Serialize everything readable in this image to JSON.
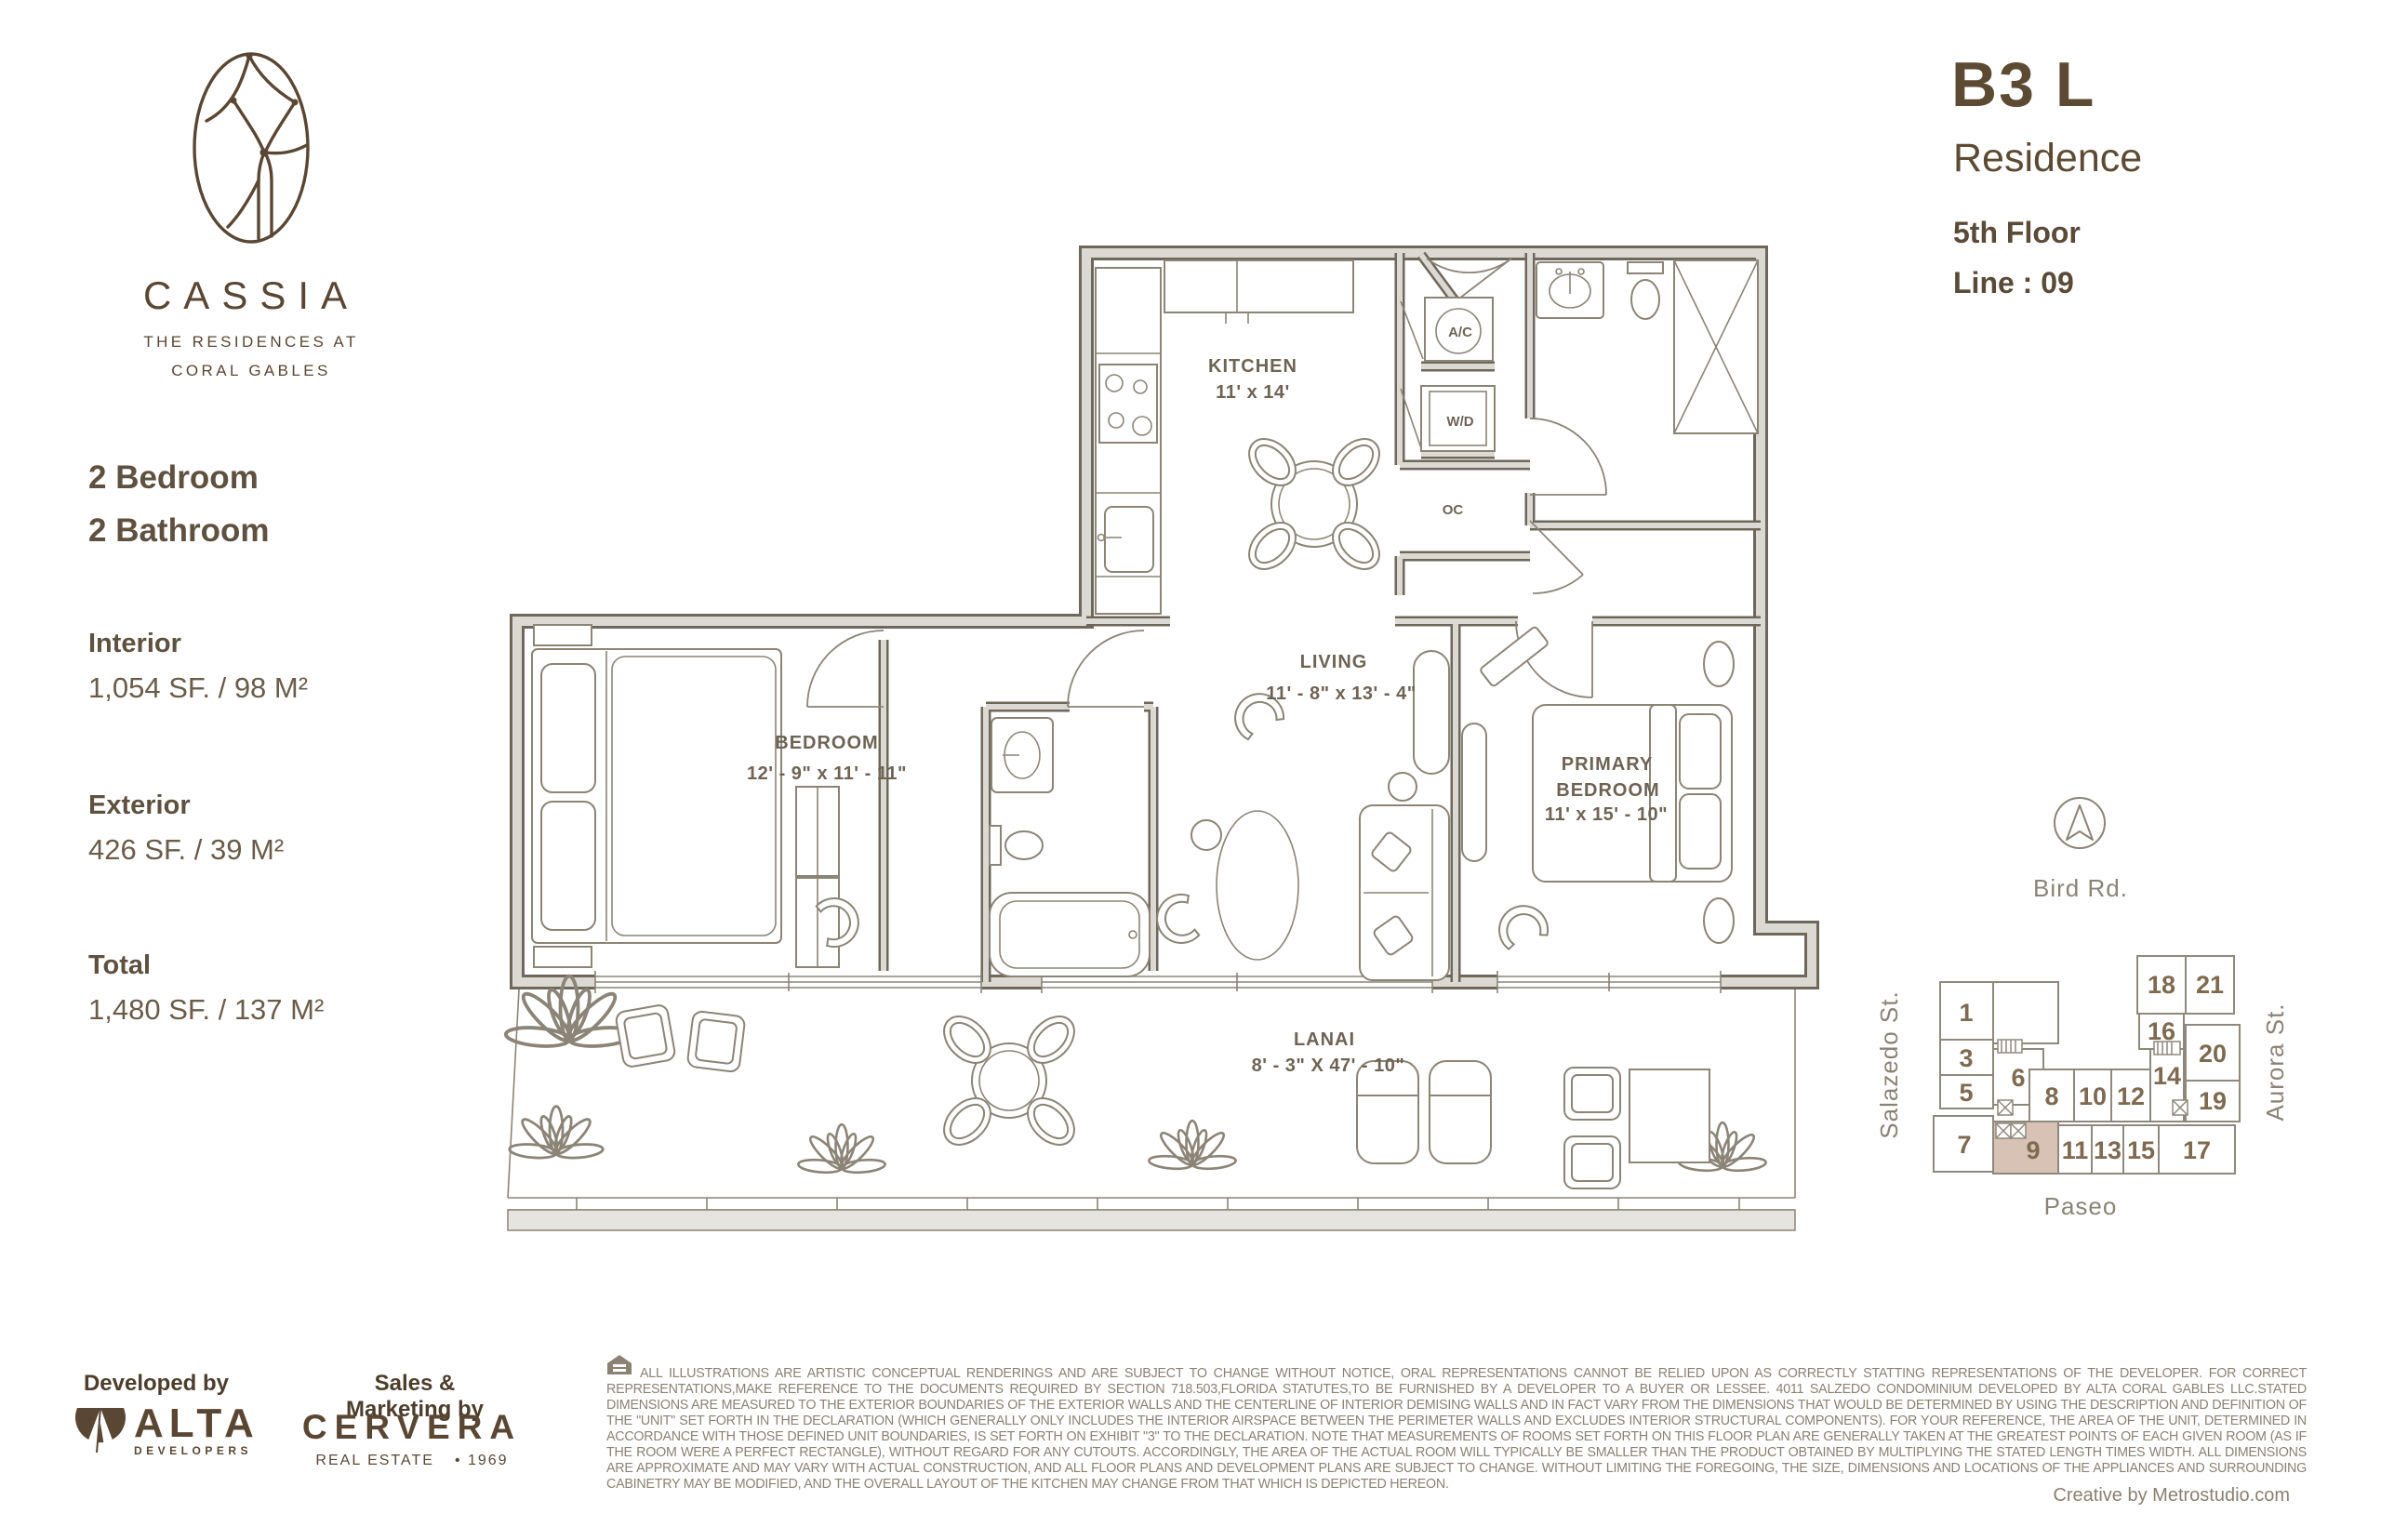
{
  "brand": {
    "name": "CASSIA",
    "tagline1": "THE RESIDENCES AT",
    "tagline2": "CORAL GABLES"
  },
  "unit": {
    "model": "B3 L",
    "label": "Residence",
    "floor": "5th Floor",
    "line": "Line : 09"
  },
  "summary": {
    "bedrooms": "2 Bedroom",
    "bathrooms": "2 Bathroom",
    "interior_label": "Interior",
    "interior": "1,054 SF. / 98 M²",
    "exterior_label": "Exterior",
    "exterior": "426 SF. / 39 M²",
    "total_label": "Total",
    "total": "1,480 SF. / 137 M²"
  },
  "plan": {
    "kitchen": {
      "name": "KITCHEN",
      "dims": "11' x 14'"
    },
    "living": {
      "name": "LIVING",
      "dims": "11' - 8\" x 13' - 4\""
    },
    "bedroom": {
      "name": "BEDROOM",
      "dims": "12' - 9\" x 11' - 11\""
    },
    "primary": {
      "line1": "PRIMARY",
      "line2": "BEDROOM",
      "dims": "11' x 15' - 10\""
    },
    "lanai": {
      "name": "LANAI",
      "dims": "8' - 3\" X 47' - 10\""
    },
    "closets": {
      "ac": "A/C",
      "wd": "W/D",
      "oc": "OC"
    }
  },
  "map": {
    "north_label": "Bird Rd.",
    "street_left": "Salazedo St.",
    "street_right": "Aurora St.",
    "promenade": "Paseo",
    "highlighted_unit": "9",
    "units": {
      "u1": "1",
      "u3": "3",
      "u5": "5",
      "u7": "7",
      "u6": "6",
      "u8": "8",
      "u10": "10",
      "u12": "12",
      "u14": "14",
      "u16": "16",
      "u18": "18",
      "u21": "21",
      "u20": "20",
      "u19": "19",
      "u9": "9",
      "u11": "11",
      "u13": "13",
      "u15": "15",
      "u17": "17"
    }
  },
  "footer": {
    "developed_by": "Developed by",
    "developer": "ALTA",
    "developer_sub": "DEVELOPERS",
    "sales_by": "Sales & Marketing by",
    "broker": "CERVERA",
    "broker_sub": "REAL ESTATE",
    "broker_year": "• 1969",
    "credit": "Creative by Metrostudio.com",
    "disclaimer": "ALL ILLUSTRATIONS ARE ARTISTIC CONCEPTUAL RENDERINGS AND ARE SUBJECT TO CHANGE WITHOUT NOTICE, ORAL REPRESENTATIONS CANNOT BE RELIED UPON AS CORRECTLY STATTING REPRESENTATIONS OF THE DEVELOPER. FOR CORRECT REPRESENTATIONS,MAKE REFERENCE TO THE DOCUMENTS REQUIRED BY SECTION 718.503,FLORIDA STATUTES,TO BE FURNISHED BY A DEVELOPER TO A BUYER OR LESSEE. 4011 SALZEDO CONDOMINIUM DEVELOPED BY ALTA CORAL GABLES LLC.STATED DIMENSIONS ARE MEASURED TO THE EXTERIOR BOUNDARIES OF THE EXTERIOR WALLS AND THE CENTERLINE OF INTERIOR DEMISING WALLS AND IN FACT VARY FROM THE DIMENSIONS THAT WOULD BE DETERMINED BY USING THE DESCRIPTION AND DEFINITION OF THE \"UNIT\" SET FORTH IN THE DECLARATION (WHICH GENERALLY ONLY INCLUDES THE INTERIOR AIRSPACE BETWEEN THE PERIMETER WALLS AND EXCLUDES INTERIOR STRUCTURAL COMPONENTS).  FOR YOUR REFERENCE, THE AREA OF THE UNIT, DETERMINED IN ACCORDANCE WITH THOSE DEFINED UNIT BOUNDARIES, IS SET FORTH ON EXHIBIT \"3\" TO THE DECLARATION.  NOTE THAT MEASUREMENTS OF ROOMS SET FORTH ON THIS FLOOR PLAN ARE GENERALLY TAKEN AT THE GREATEST POINTS OF EACH GIVEN ROOM (AS IF THE ROOM WERE A PERFECT RECTANGLE), WITHOUT REGARD FOR ANY CUTOUTS.  ACCORDINGLY, THE AREA OF THE ACTUAL ROOM WILL TYPICALLY BE SMALLER THAN THE PRODUCT OBTAINED BY MULTIPLYING THE STATED LENGTH TIMES WIDTH.  ALL DIMENSIONS ARE APPROXIMATE AND MAY VARY WITH ACTUAL CONSTRUCTION, AND ALL FLOOR PLANS AND DEVELOPMENT PLANS ARE SUBJECT TO CHANGE.  WITHOUT LIMITING THE FOREGOING, THE SIZE, DIMENSIONS AND LOCATIONS OF THE APPLIANCES AND SURROUNDING CABINETRY MAY BE MODIFIED, AND THE OVERALL LAYOUT OF THE KITCHEN MAY CHANGE FROM THAT WHICH IS DEPICTED HEREON."
  },
  "colors": {
    "brand_brown": "#5a4733",
    "text_brown": "#5f5140",
    "plan_line": "#8b8477",
    "wall_fill": "#dcd9d3",
    "wall_edge": "#6e675c",
    "highlight_unit": "#d8c1b5",
    "muted_gray": "#8a8377"
  }
}
